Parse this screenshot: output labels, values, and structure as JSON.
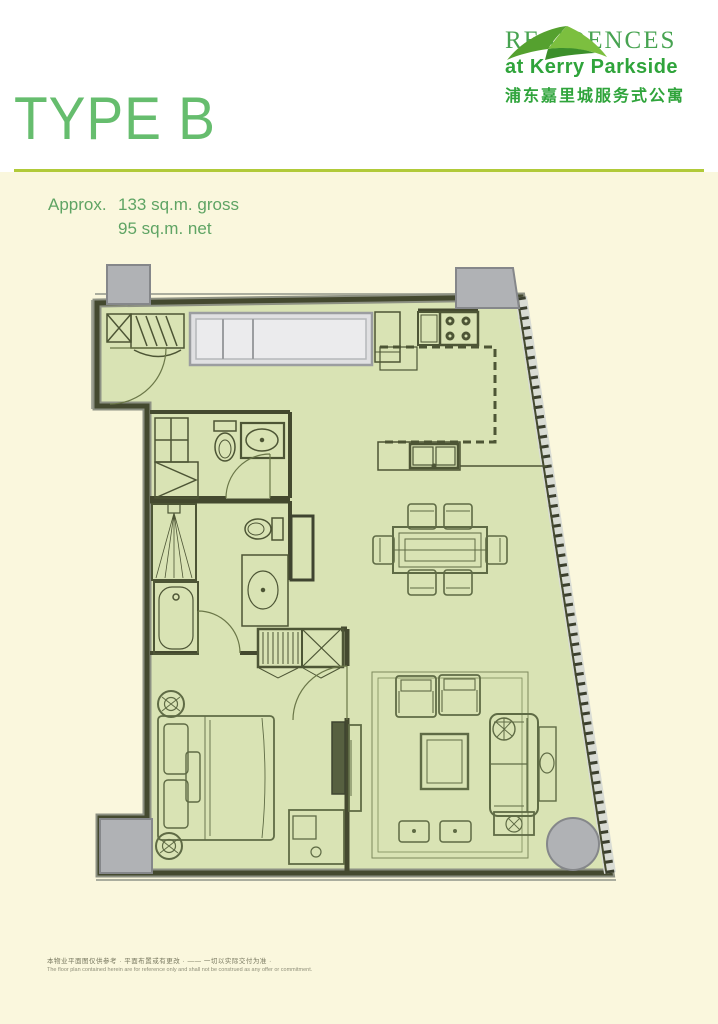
{
  "page": {
    "title": "TYPE B"
  },
  "brand": {
    "name": "RESIDENCES",
    "subtitle": "at Kerry Parkside",
    "chinese": "浦东嘉里城服务式公寓"
  },
  "area": {
    "prefix": "Approx.",
    "gross": "133 sq.m. gross",
    "net": "95 sq.m. net"
  },
  "disclaimer": {
    "zh": "本物业平面图仅供参考 · 平面布置或有更改 · —— 一切以实际交付为准 ·",
    "en": "The floor plan contained herein are for reference only and shall not be construed as any offer or commitment."
  },
  "colors": {
    "title_green": "#66bd6e",
    "rule_green": "#b1ca39",
    "brand_green": "#2fa43b",
    "cream": "#faf7dd",
    "plan_fill": "#d9e3b4",
    "wall": "#44492f",
    "column_gray": "#b0b2b5"
  },
  "floor_plan": {
    "rooms": [
      "entry",
      "kitchen",
      "dining-area",
      "living-room",
      "bedroom",
      "bathroom",
      "master-bathroom",
      "hallway",
      "closet"
    ],
    "furniture": [
      "entry-closet",
      "luggage-rack",
      "wardrobe",
      "fridge",
      "stove",
      "kitchen-sink",
      "toilet",
      "washbasin",
      "shower",
      "bathtub",
      "vanity-basin",
      "linen-cabinet",
      "dining-table",
      "dining-chairs",
      "double-bed",
      "bedside-tables",
      "tv-console",
      "desk",
      "armchairs",
      "coffee-table",
      "sofa",
      "side-table",
      "floor-lamp",
      "ottomans"
    ],
    "structure": [
      "concrete-columns",
      "angled-window-wall",
      "door-swings"
    ]
  }
}
